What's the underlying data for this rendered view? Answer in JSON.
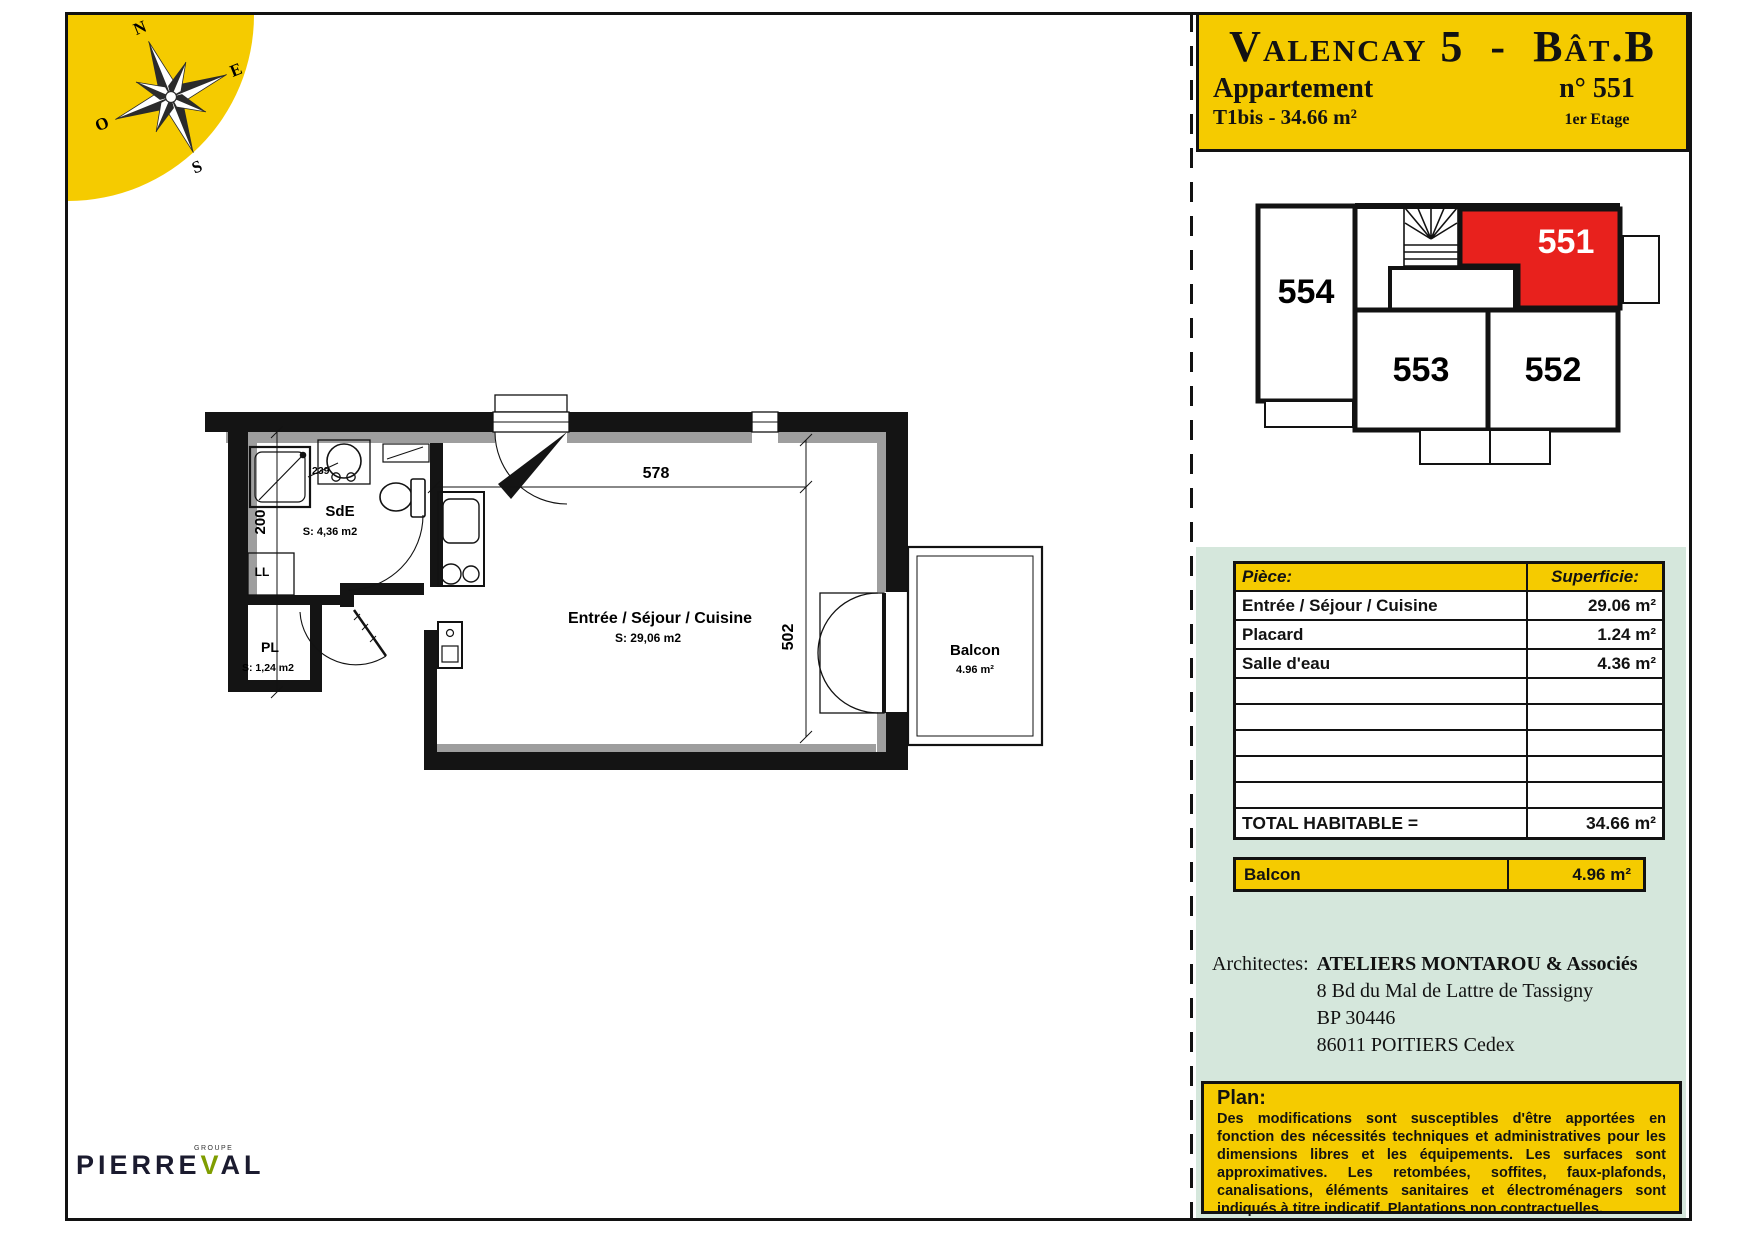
{
  "header": {
    "title_part1": "Valencay 5",
    "title_dash": "-",
    "title_part2": "Bât.B",
    "apartment_label": "Appartement",
    "unit_number": "n° 551",
    "type_surface": "T1bis - 34.66 m²",
    "floor": "1er Etage"
  },
  "compass": {
    "north": "N",
    "east": "E",
    "south": "S",
    "west": "O"
  },
  "key_plan": {
    "units": [
      {
        "id": "554",
        "highlighted": false
      },
      {
        "id": "551",
        "highlighted": true
      },
      {
        "id": "553",
        "highlighted": false
      },
      {
        "id": "552",
        "highlighted": false
      }
    ]
  },
  "floor_plan": {
    "rooms": {
      "sde": {
        "name": "SdE",
        "area": "S: 4,36 m2"
      },
      "pl": {
        "name": "PL",
        "area": "S: 1,24 m2"
      },
      "sejour": {
        "name": "Entrée / Séjour / Cuisine",
        "area": "S: 29,06 m2"
      },
      "balcon": {
        "name": "Balcon",
        "area": "4.96 m²"
      }
    },
    "labels": {
      "washing_machine": "LL"
    },
    "dimensions": {
      "top_width": "578",
      "right_height": "502",
      "left_height": "200",
      "small": "239"
    }
  },
  "surface_table": {
    "header": {
      "piece": "Pièce:",
      "superficie": "Superficie:"
    },
    "rows": [
      {
        "piece": "Entrée / Séjour / Cuisine",
        "superficie": "29.06 m²"
      },
      {
        "piece": "Placard",
        "superficie": "1.24 m²"
      },
      {
        "piece": "Salle d'eau",
        "superficie": "4.36 m²"
      }
    ],
    "total_label": "TOTAL HABITABLE =",
    "total_value": "34.66 m²",
    "balcon_label": "Balcon",
    "balcon_value": "4.96 m²"
  },
  "architects": {
    "label": "Architectes:",
    "name": "ATELIERS MONTAROU & Associés",
    "address_line1": "8 Bd du Mal de Lattre de Tassigny",
    "address_line2": "BP 30446",
    "address_line3": "86011 POITIERS Cedex"
  },
  "plan_note": {
    "title": "Plan:",
    "body": "Des modifications sont susceptibles d'être apportées en fonction des nécessités techniques et administratives pour les dimensions libres et les équipements.  Les surfaces sont approximatives.  Les retombées, soffites, faux-plafonds, canalisations, éléments sanitaires et électroménagers sont indiqués à titre indicatif.  Plantations non contractuelles."
  },
  "logo": {
    "brand_pre": "PIERRE",
    "brand_v": "V",
    "brand_post": "AL",
    "tagline": "GROUPE"
  },
  "colors": {
    "accent_yellow": "#F5CB00",
    "highlight_red": "#E8211D",
    "panel_green": "#D5E7DC"
  }
}
